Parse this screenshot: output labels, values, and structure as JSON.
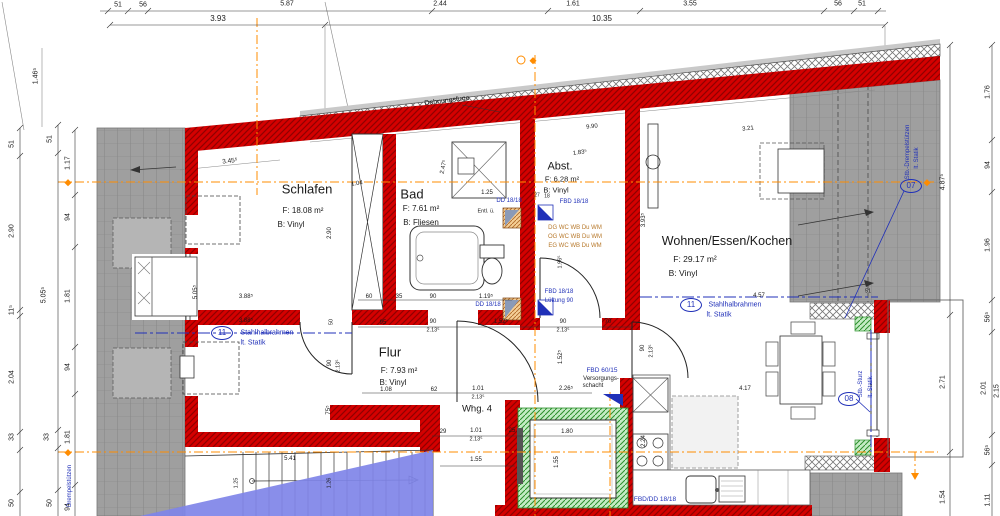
{
  "drawing": {
    "type": "floor-plan",
    "unit_label": "Whg. 4",
    "colors": {
      "text": "#1a1a1a",
      "blue": "#2030b8",
      "amber": "#b7782a",
      "wall_red": "#d40000",
      "roof_gray": "#9f9f9f",
      "green": "#2c8f2c",
      "orange_axis": "#ff8c00",
      "blue_wedge": "#7f84e8"
    },
    "rooms": [
      {
        "name": "Schlafen",
        "area": "F: 18.08 m²",
        "floor": "B: Vinyl"
      },
      {
        "name": "Bad",
        "area": "F: 7.61 m²",
        "floor": "B: Fliesen"
      },
      {
        "name": "Abst.",
        "area": "F: 6.28 m²",
        "floor": "B: Vinyl"
      },
      {
        "name": "Wohnen/Essen/Kochen",
        "area": "F: 29.17 m²",
        "floor": "B: Vinyl"
      },
      {
        "name": "Flur",
        "area": "F: 7.93 m²",
        "floor": "B: Vinyl"
      }
    ]
  },
  "circles": [
    {
      "n": "axis-circle-11-left",
      "t": "11",
      "x": 222,
      "y": 333
    },
    {
      "n": "axis-circle-11-right",
      "t": "11",
      "x": 691,
      "y": 305
    },
    {
      "n": "axis-circle-08",
      "t": "08",
      "x": 849,
      "y": 399
    },
    {
      "n": "axis-circle-07",
      "t": "07",
      "x": 911,
      "y": 186
    }
  ],
  "labels": [
    {
      "n": "dim-top-51a",
      "t": "51",
      "x": 118,
      "y": 5,
      "s": 7
    },
    {
      "n": "dim-top-56a",
      "t": "56",
      "x": 143,
      "y": 5,
      "s": 7
    },
    {
      "n": "dim-top-587",
      "t": "5.87",
      "x": 287,
      "y": 4,
      "s": 7
    },
    {
      "n": "dim-top-244",
      "t": "2.44",
      "x": 440,
      "y": 4,
      "s": 7
    },
    {
      "n": "dim-top-161",
      "t": "1.61",
      "x": 573,
      "y": 4,
      "s": 7
    },
    {
      "n": "dim-top-355",
      "t": "3.55",
      "x": 690,
      "y": 4,
      "s": 7
    },
    {
      "n": "dim-top-56b",
      "t": "56",
      "x": 838,
      "y": 4,
      "s": 7
    },
    {
      "n": "dim-top-51b",
      "t": "51",
      "x": 862,
      "y": 4,
      "s": 7
    },
    {
      "n": "dim-top-393",
      "t": "3.93",
      "x": 218,
      "y": 19,
      "s": 8
    },
    {
      "n": "dim-top-1035",
      "t": "10.35",
      "x": 602,
      "y": 19,
      "s": 8
    },
    {
      "n": "dim-left-51a",
      "t": "51",
      "x": 12,
      "y": 144,
      "s": 7,
      "r": -90
    },
    {
      "n": "dim-left-290",
      "t": "2.90",
      "x": 12,
      "y": 231,
      "s": 7,
      "r": -90
    },
    {
      "n": "dim-left-115",
      "t": "11⁵",
      "x": 12,
      "y": 310,
      "s": 7,
      "r": -90
    },
    {
      "n": "dim-left-204",
      "t": "2.04",
      "x": 12,
      "y": 377,
      "s": 7,
      "r": -90
    },
    {
      "n": "dim-left-33a",
      "t": "33",
      "x": 12,
      "y": 437,
      "s": 7,
      "r": -90
    },
    {
      "n": "dim-left-50a",
      "t": "50",
      "x": 12,
      "y": 503,
      "s": 7,
      "r": -90
    },
    {
      "n": "dim-left-51b",
      "t": "51",
      "x": 50,
      "y": 139,
      "s": 7,
      "r": -90
    },
    {
      "n": "dim-left-5055",
      "t": "5.05⁵",
      "x": 44,
      "y": 295,
      "s": 7,
      "r": -90
    },
    {
      "n": "dim-left-33b",
      "t": "33",
      "x": 47,
      "y": 437,
      "s": 7,
      "r": -90
    },
    {
      "n": "dim-left-50b",
      "t": "50",
      "x": 50,
      "y": 503,
      "s": 7,
      "r": -90
    },
    {
      "n": "dim-left-117",
      "t": "1.17",
      "x": 68,
      "y": 163,
      "s": 7,
      "r": -90
    },
    {
      "n": "dim-left-94a",
      "t": "94",
      "x": 68,
      "y": 217,
      "s": 7,
      "r": -90
    },
    {
      "n": "dim-left-181a",
      "t": "1.81",
      "x": 68,
      "y": 296,
      "s": 7,
      "r": -90
    },
    {
      "n": "dim-left-94b",
      "t": "94",
      "x": 68,
      "y": 367,
      "s": 7,
      "r": -90
    },
    {
      "n": "dim-left-181b",
      "t": "1.81",
      "x": 68,
      "y": 437,
      "s": 7,
      "r": -90
    },
    {
      "n": "dim-left-94c",
      "t": "94",
      "x": 68,
      "y": 507,
      "s": 7,
      "r": -90
    },
    {
      "n": "dim-left-1465",
      "t": "1.46⁵",
      "x": 36,
      "y": 76,
      "s": 7,
      "r": -90
    },
    {
      "n": "dim-right-4875",
      "t": "4.87⁵",
      "x": 943,
      "y": 182,
      "s": 7,
      "r": -90
    },
    {
      "n": "dim-right-271",
      "t": "2.71",
      "x": 943,
      "y": 382,
      "s": 7,
      "r": -90
    },
    {
      "n": "dim-right-154",
      "t": "1.54",
      "x": 943,
      "y": 497,
      "s": 7,
      "r": -90
    },
    {
      "n": "dim-right-176",
      "t": "1.76",
      "x": 988,
      "y": 92,
      "s": 7,
      "r": -90
    },
    {
      "n": "dim-right-94",
      "t": "94",
      "x": 988,
      "y": 165,
      "s": 7,
      "r": -90
    },
    {
      "n": "dim-right-196",
      "t": "1.96",
      "x": 988,
      "y": 245,
      "s": 7,
      "r": -90
    },
    {
      "n": "dim-right-565a",
      "t": "56⁵",
      "x": 988,
      "y": 317,
      "s": 7,
      "r": -90
    },
    {
      "n": "dim-right-201",
      "t": "2.01",
      "x": 984,
      "y": 388,
      "s": 7,
      "r": -90
    },
    {
      "n": "dim-right-215",
      "t": "2.15",
      "x": 997,
      "y": 391,
      "s": 7,
      "r": -90
    },
    {
      "n": "dim-right-565b",
      "t": "56⁵",
      "x": 988,
      "y": 450,
      "s": 7,
      "r": -90
    },
    {
      "n": "dim-right-111",
      "t": "1.11",
      "x": 988,
      "y": 500,
      "s": 7,
      "r": -90
    },
    {
      "n": "room-schlafen-name",
      "t": "Schlafen",
      "x": 307,
      "y": 189,
      "s": 13
    },
    {
      "n": "room-schlafen-area",
      "t": "F: 18.08 m²",
      "x": 303,
      "y": 211,
      "s": 8
    },
    {
      "n": "room-schlafen-floor",
      "t": "B: Vinyl",
      "x": 291,
      "y": 225,
      "s": 8
    },
    {
      "n": "room-bad-name",
      "t": "Bad",
      "x": 412,
      "y": 194,
      "s": 13
    },
    {
      "n": "room-bad-area",
      "t": "F: 7.61 m²",
      "x": 421,
      "y": 209,
      "s": 8
    },
    {
      "n": "room-bad-floor",
      "t": "B: Fliesen",
      "x": 421,
      "y": 223,
      "s": 8
    },
    {
      "n": "room-abst-name",
      "t": "Abst.",
      "x": 560,
      "y": 167,
      "s": 11
    },
    {
      "n": "room-abst-area",
      "t": "F: 6.28 m²",
      "x": 562,
      "y": 179,
      "s": 7.5
    },
    {
      "n": "room-abst-floor",
      "t": "B: Vinyl",
      "x": 556,
      "y": 190,
      "s": 7.5
    },
    {
      "n": "room-wohnen-name",
      "t": "Wohnen/Essen/Kochen",
      "x": 727,
      "y": 241,
      "s": 12.5
    },
    {
      "n": "room-wohnen-area",
      "t": "F: 29.17 m²",
      "x": 695,
      "y": 259,
      "s": 8.5
    },
    {
      "n": "room-wohnen-floor",
      "t": "B: Vinyl",
      "x": 683,
      "y": 273,
      "s": 8.5
    },
    {
      "n": "room-flur-name",
      "t": "Flur",
      "x": 390,
      "y": 352,
      "s": 13
    },
    {
      "n": "room-flur-area",
      "t": "F: 7.93 m²",
      "x": 399,
      "y": 371,
      "s": 8
    },
    {
      "n": "room-flur-floor",
      "t": "B: Vinyl",
      "x": 393,
      "y": 383,
      "s": 8
    },
    {
      "n": "unit-label",
      "t": "Whg. 4",
      "x": 477,
      "y": 409,
      "s": 9.5
    },
    {
      "n": "dehnungsfuge-label",
      "t": "Dehnungsfuge",
      "x": 447,
      "y": 101,
      "s": 7,
      "r": -7
    },
    {
      "n": "dim-990",
      "t": "9.90",
      "x": 592,
      "y": 127,
      "s": 6,
      "r": -7
    },
    {
      "n": "dim-3455",
      "t": "3.45⁵",
      "x": 230,
      "y": 162,
      "s": 6.5,
      "r": -7
    },
    {
      "n": "dim-104",
      "t": "1.04",
      "x": 357,
      "y": 184,
      "s": 6,
      "r": -8
    },
    {
      "n": "dim-1835",
      "t": "1.83⁵",
      "x": 580,
      "y": 153,
      "s": 6,
      "r": -8
    },
    {
      "n": "dim-321",
      "t": "3.21",
      "x": 748,
      "y": 129,
      "s": 6,
      "r": -7
    },
    {
      "n": "dim-2475",
      "t": "2.47⁵",
      "x": 444,
      "y": 167,
      "s": 6,
      "r": -78
    },
    {
      "n": "dim-290-schlafen",
      "t": "2.90",
      "x": 330,
      "y": 233,
      "s": 6,
      "r": -90
    },
    {
      "n": "dim-125-bad",
      "t": "1.25",
      "x": 487,
      "y": 193,
      "s": 6
    },
    {
      "n": "dim-1195",
      "t": "1.19⁵",
      "x": 486,
      "y": 297,
      "s": 6
    },
    {
      "n": "dim-60",
      "t": "60",
      "x": 369,
      "y": 297,
      "s": 6
    },
    {
      "n": "dim-35",
      "t": "35",
      "x": 399,
      "y": 297,
      "s": 6
    },
    {
      "n": "dim-90a",
      "t": "90",
      "x": 433,
      "y": 297,
      "s": 6
    },
    {
      "n": "dim-95",
      "t": "95",
      "x": 383,
      "y": 323,
      "s": 6
    },
    {
      "n": "dim-90b",
      "t": "90",
      "x": 433,
      "y": 322,
      "s": 6
    },
    {
      "n": "dim-2135a",
      "t": "2.13⁵",
      "x": 433,
      "y": 331,
      "s": 5.5
    },
    {
      "n": "dim-1525a",
      "t": "1.52⁵",
      "x": 501,
      "y": 322,
      "s": 6
    },
    {
      "n": "dim-90c",
      "t": "90",
      "x": 563,
      "y": 322,
      "s": 6
    },
    {
      "n": "dim-2135b",
      "t": "2.13⁵",
      "x": 563,
      "y": 331,
      "s": 5.5
    },
    {
      "n": "dim-70",
      "t": "70",
      "x": 608,
      "y": 322,
      "s": 6
    },
    {
      "n": "dim-3885a",
      "t": "3.88⁵",
      "x": 246,
      "y": 297,
      "s": 6
    },
    {
      "n": "dim-3885b",
      "t": "3.88⁵",
      "x": 246,
      "y": 321,
      "s": 6
    },
    {
      "n": "dim-5055-inner",
      "t": "5.05⁵",
      "x": 196,
      "y": 292,
      "s": 6,
      "r": -90
    },
    {
      "n": "dim-50-inner",
      "t": "50",
      "x": 332,
      "y": 322,
      "s": 5.5,
      "r": -90
    },
    {
      "n": "dim-90-door-left",
      "t": "90",
      "x": 330,
      "y": 363,
      "s": 6,
      "r": -90
    },
    {
      "n": "dim-2135-door-left",
      "t": "2.13⁵",
      "x": 339,
      "y": 366,
      "s": 5.5,
      "r": -90
    },
    {
      "n": "dim-755",
      "t": "75⁵",
      "x": 329,
      "y": 410,
      "s": 6,
      "r": -90
    },
    {
      "n": "dim-108",
      "t": "1.08",
      "x": 386,
      "y": 390,
      "s": 6
    },
    {
      "n": "dim-62",
      "t": "62",
      "x": 434,
      "y": 390,
      "s": 6
    },
    {
      "n": "dim-101a",
      "t": "1.01",
      "x": 478,
      "y": 389,
      "s": 6
    },
    {
      "n": "dim-2135c",
      "t": "2.13⁵",
      "x": 478,
      "y": 398,
      "s": 5.5
    },
    {
      "n": "dim-2265",
      "t": "2.26⁵",
      "x": 566,
      "y": 389,
      "s": 6
    },
    {
      "n": "dim-29",
      "t": "29",
      "x": 443,
      "y": 432,
      "s": 6
    },
    {
      "n": "dim-101b",
      "t": "1.01",
      "x": 476,
      "y": 431,
      "s": 6
    },
    {
      "n": "dim-2135d",
      "t": "2.13⁵",
      "x": 476,
      "y": 440,
      "s": 5.5
    },
    {
      "n": "dim-25",
      "t": "25",
      "x": 512,
      "y": 431,
      "s": 6
    },
    {
      "n": "dim-155a",
      "t": "1.55",
      "x": 476,
      "y": 460,
      "s": 6
    },
    {
      "n": "dim-180",
      "t": "1.80",
      "x": 567,
      "y": 432,
      "s": 6
    },
    {
      "n": "dim-155b",
      "t": "1.55",
      "x": 557,
      "y": 462,
      "s": 6,
      "r": -90
    },
    {
      "n": "dim-1525b",
      "t": "1.52⁵",
      "x": 561,
      "y": 357,
      "s": 6,
      "r": -90
    },
    {
      "n": "dim-90-door-k",
      "t": "90",
      "x": 643,
      "y": 348,
      "s": 6,
      "r": -90
    },
    {
      "n": "dim-2135-door-k",
      "t": "2.13⁵",
      "x": 652,
      "y": 351,
      "s": 5.5,
      "r": -90
    },
    {
      "n": "dim-1965",
      "t": "1.96⁵",
      "x": 561,
      "y": 262,
      "s": 5.5,
      "r": -90
    },
    {
      "n": "dim-541",
      "t": "5.41",
      "x": 290,
      "y": 459,
      "s": 6
    },
    {
      "n": "dim-125-stair",
      "t": "1.25",
      "x": 237,
      "y": 483,
      "s": 5.5,
      "r": -90
    },
    {
      "n": "dim-126-stair",
      "t": "1.26",
      "x": 330,
      "y": 483,
      "s": 5.5,
      "r": -90
    },
    {
      "n": "dim-417",
      "t": "4.17",
      "x": 745,
      "y": 389,
      "s": 6
    },
    {
      "n": "dim-224",
      "t": "2.24",
      "x": 644,
      "y": 441,
      "s": 6,
      "r": -90
    },
    {
      "n": "dim-457",
      "t": "4.57",
      "x": 759,
      "y": 296,
      "s": 6
    },
    {
      "n": "dim-3935",
      "t": "3.93⁵",
      "x": 644,
      "y": 220,
      "s": 6,
      "r": -90
    },
    {
      "n": "dim-51-roof",
      "t": "51",
      "x": 868,
      "y": 292,
      "s": 5.5
    },
    {
      "n": "dim-27",
      "t": "27",
      "x": 537,
      "y": 196,
      "s": 5
    },
    {
      "n": "dim-18",
      "t": "18",
      "x": 547,
      "y": 197,
      "s": 5
    },
    {
      "n": "ann-dd1818-a",
      "t": "DD 18/18",
      "x": 509,
      "y": 201,
      "s": 6,
      "c": "b"
    },
    {
      "n": "ann-entl",
      "t": "Entl. ü.",
      "x": 486,
      "y": 212,
      "s": 5.5
    },
    {
      "n": "ann-fbd1818-a",
      "t": "FBD 18/18",
      "x": 574,
      "y": 202,
      "s": 6,
      "c": "b"
    },
    {
      "n": "ann-dd1818-b",
      "t": "DD 18/18",
      "x": 488,
      "y": 305,
      "s": 6,
      "c": "b"
    },
    {
      "n": "ann-fbd1818-b",
      "t": "FBD 18/18",
      "x": 559,
      "y": 292,
      "s": 6,
      "c": "b"
    },
    {
      "n": "ann-lueftung",
      "t": "Lüftung 90",
      "x": 559,
      "y": 301,
      "s": 6,
      "c": "b"
    },
    {
      "n": "ann-fbd6015",
      "t": "FBD 60/15",
      "x": 602,
      "y": 371,
      "s": 6.5,
      "c": "b"
    },
    {
      "n": "ann-versorgungs",
      "t": "Versorgungs-",
      "x": 601,
      "y": 379,
      "s": 6
    },
    {
      "n": "ann-schacht",
      "t": "schacht",
      "x": 593,
      "y": 386,
      "s": 6
    },
    {
      "n": "ann-fbddd1818",
      "t": "FBD/DD 18/18",
      "x": 655,
      "y": 500,
      "s": 6.5,
      "c": "b"
    },
    {
      "n": "ann-stahlhalbrahmen-left",
      "t": "Stahlhalbrahmen",
      "x": 267,
      "y": 333,
      "s": 7,
      "c": "b"
    },
    {
      "n": "ann-stahlhalbrahmen-left2",
      "t": "lt. Statik",
      "x": 253,
      "y": 343,
      "s": 7,
      "c": "b"
    },
    {
      "n": "ann-stahlhalbrahmen-right",
      "t": "Stahlhalbrahmen",
      "x": 735,
      "y": 305,
      "s": 7,
      "c": "b"
    },
    {
      "n": "ann-stahlhalbrahmen-right2",
      "t": "lt. Statik",
      "x": 719,
      "y": 315,
      "s": 7,
      "c": "b"
    },
    {
      "n": "ann-stb-sturz",
      "t": "Stb.-Sturz",
      "x": 861,
      "y": 384,
      "s": 6,
      "c": "b",
      "r": -90
    },
    {
      "n": "ann-stb-sturz2",
      "t": "lt. Statik",
      "x": 871,
      "y": 387,
      "s": 6,
      "c": "b",
      "r": -90
    },
    {
      "n": "ann-drempel-right",
      "t": "Stb.-Drempelstützen",
      "x": 908,
      "y": 152,
      "s": 6,
      "c": "b",
      "r": -90
    },
    {
      "n": "ann-drempel-right2",
      "t": "lt. Statik",
      "x": 917,
      "y": 158,
      "s": 6,
      "c": "b",
      "r": -90
    },
    {
      "n": "ann-drempel-left",
      "t": "Drempelstützen",
      "x": 70,
      "y": 486,
      "s": 6,
      "c": "b",
      "r": -90
    },
    {
      "n": "ann-dg",
      "t": "DG  WC  WB  Du  WM",
      "x": 575,
      "y": 228,
      "s": 6,
      "c": "a"
    },
    {
      "n": "ann-og",
      "t": "OG  WC  WB  Du  WM",
      "x": 575,
      "y": 237,
      "s": 6,
      "c": "a"
    },
    {
      "n": "ann-eg",
      "t": "EG  WC  WB  Du  WM",
      "x": 575,
      "y": 246,
      "s": 6,
      "c": "a"
    }
  ]
}
